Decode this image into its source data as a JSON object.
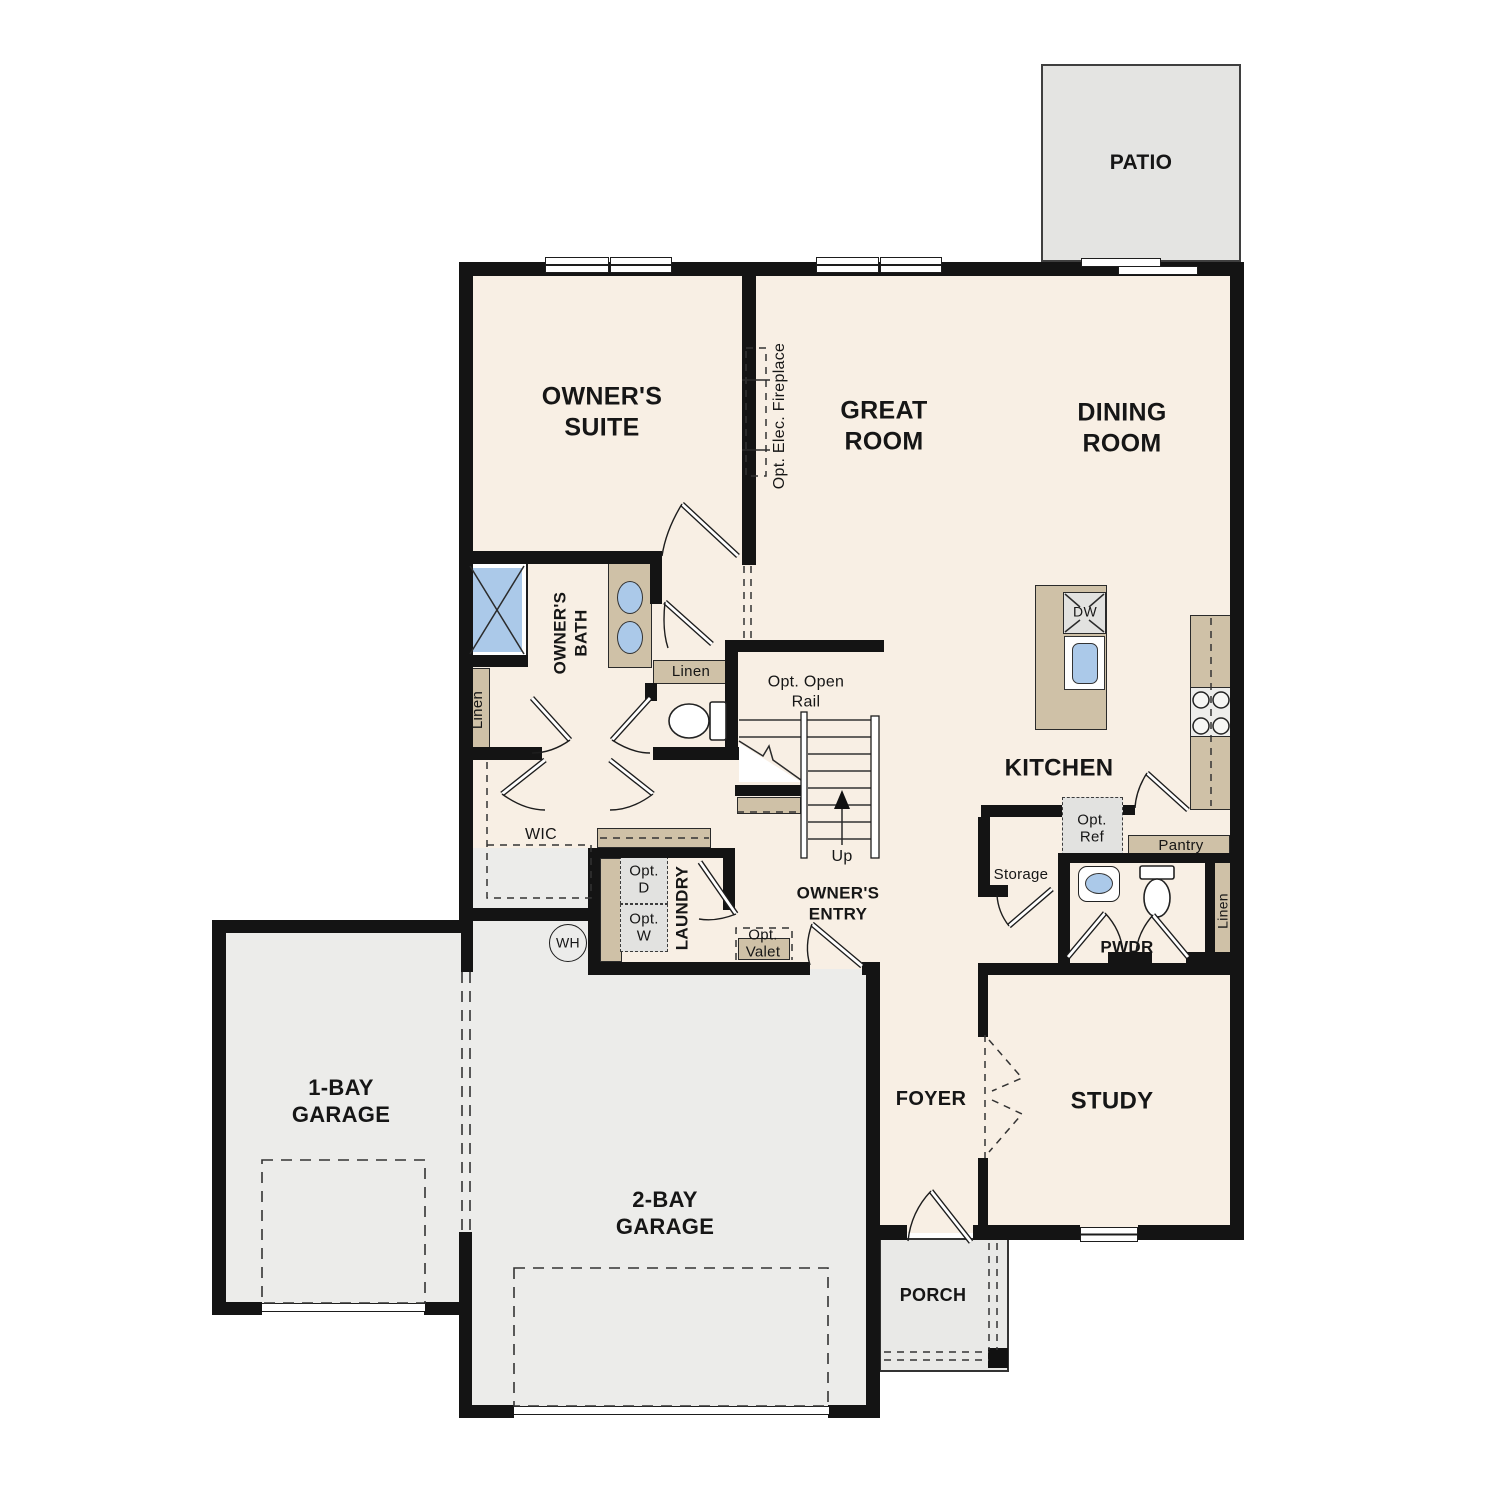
{
  "colors": {
    "floor": "#f8efe4",
    "garage": "#ececea",
    "patio": "#e4e4e2",
    "porch": "#e9e9e7",
    "tan": "#cfc1a7",
    "fixture_blue": "#abc9e9",
    "wall": "#141414",
    "optbox": "#e2e2e0"
  },
  "rooms": {
    "patio": "PATIO",
    "owners_suite": "OWNER'S\nSUITE",
    "great_room": "GREAT\nROOM",
    "dining_room": "DINING\nROOM",
    "kitchen": "KITCHEN",
    "owners_bath": "OWNER'S\nBATH",
    "wic": "WIC",
    "laundry": "LAUNDRY",
    "owners_entry": "OWNER'S\nENTRY",
    "pwdr": "PWDR",
    "foyer": "FOYER",
    "study": "STUDY",
    "garage_1bay": "1-BAY\nGARAGE",
    "garage_2bay": "2-BAY\nGARAGE",
    "porch": "PORCH"
  },
  "annotations": {
    "opt_elec_fireplace": "Opt. Elec. Fireplace",
    "opt_open_rail": "Opt. Open\nRail",
    "up": "Up",
    "linen_bath_closet": "Linen",
    "linen_bath_cabinet": "Linen",
    "linen_pwdr": "Linen",
    "opt_dryer": "Opt.\nD",
    "opt_washer": "Opt.\nW",
    "water_heater": "WH",
    "opt_valet": "Opt.\nValet",
    "dishwasher": "DW",
    "opt_ref": "Opt.\nRef",
    "pantry": "Pantry",
    "storage": "Storage"
  }
}
